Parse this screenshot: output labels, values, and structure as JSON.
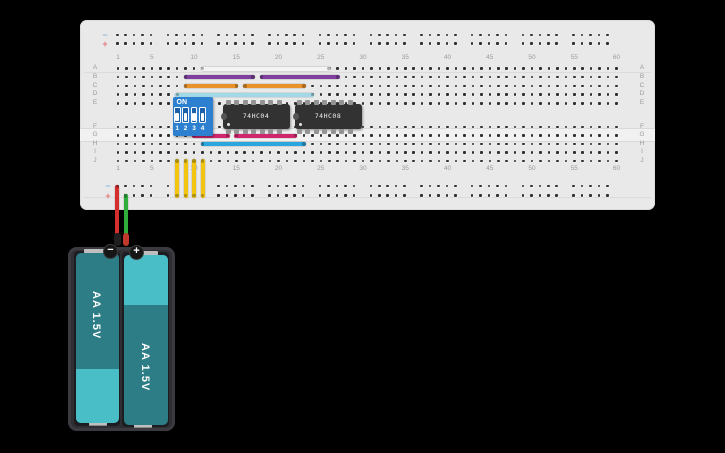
{
  "app": {
    "background": "#000000"
  },
  "breadboard": {
    "body_color": "#e9e9e9",
    "row_letters_top": [
      "A",
      "B",
      "C",
      "D",
      "E"
    ],
    "row_letters_bottom": [
      "F",
      "G",
      "H",
      "I",
      "J"
    ],
    "column_numbers": [
      "1",
      "5",
      "10",
      "15",
      "20",
      "25",
      "30",
      "35",
      "40",
      "45",
      "50",
      "55",
      "60"
    ],
    "rail_minus_symbol": "−",
    "rail_plus_symbol": "+",
    "rail_minus_color": "#8ab6d8",
    "rail_plus_color": "#e07a7a"
  },
  "components": {
    "dip_switch": {
      "on_label": "ON",
      "switch_numbers": [
        "1",
        "2",
        "3",
        "4"
      ],
      "state": "all-off",
      "body_color": "#2c80cf"
    },
    "ic1": {
      "label": "74HC04"
    },
    "ic2": {
      "label": "74HC08"
    },
    "battery_pack": {
      "cell1": {
        "label": "AA 1.5V",
        "polarity": "−"
      },
      "cell2": {
        "label": "AA 1.5V",
        "polarity": "+"
      },
      "cell_dark_color": "#2c7d86",
      "cell_light_color": "#4abec7"
    }
  },
  "wires": {
    "horizontal": [
      {
        "name": "wire-white",
        "color": "#f4f4f4",
        "row": "A",
        "from_col": 11,
        "to_col": 26
      },
      {
        "name": "wire-purple-left",
        "color": "#7e3f9d",
        "row": "B",
        "from_col": 9,
        "to_col": 17
      },
      {
        "name": "wire-purple-right",
        "color": "#7e3f9d",
        "row": "B",
        "from_col": 18,
        "to_col": 27
      },
      {
        "name": "wire-orange-left",
        "color": "#e8932c",
        "row": "C",
        "from_col": 9,
        "to_col": 15
      },
      {
        "name": "wire-orange-right",
        "color": "#e8932c",
        "row": "C",
        "from_col": 16,
        "to_col": 23
      },
      {
        "name": "wire-cyan",
        "color": "#a3d8e6",
        "row": "D",
        "from_col": 8,
        "to_col": 24
      },
      {
        "name": "wire-pink-left",
        "color": "#d0266e",
        "row": "G",
        "from_col": 10,
        "to_col": 14
      },
      {
        "name": "wire-pink-right",
        "color": "#d0266e",
        "row": "G",
        "from_col": 15,
        "to_col": 22
      },
      {
        "name": "wire-blue",
        "color": "#2ba7e0",
        "row": "H",
        "from_col": 11,
        "to_col": 23
      }
    ],
    "vertical": [
      {
        "name": "wire-yellow-1",
        "color": "#f2c513",
        "col": 8,
        "from_row": "J",
        "to_rail": "bottom-plus"
      },
      {
        "name": "wire-yellow-2",
        "color": "#f2c513",
        "col": 9,
        "from_row": "J",
        "to_rail": "bottom-plus"
      },
      {
        "name": "wire-yellow-3",
        "color": "#f2c513",
        "col": 10,
        "from_row": "J",
        "to_rail": "bottom-plus"
      },
      {
        "name": "wire-yellow-4",
        "color": "#f2c513",
        "col": 11,
        "from_row": "J",
        "to_rail": "bottom-plus"
      }
    ],
    "power": [
      {
        "name": "wire-red",
        "color": "#d42e2e",
        "rail": "bottom-minus",
        "rail_hole": 1,
        "terminal": "negative",
        "cap_color": "#1f1f1f"
      },
      {
        "name": "wire-green",
        "color": "#2fae3e",
        "rail": "bottom-plus",
        "rail_hole": 2,
        "terminal": "positive",
        "cap_color": "#c0392b"
      }
    ]
  }
}
